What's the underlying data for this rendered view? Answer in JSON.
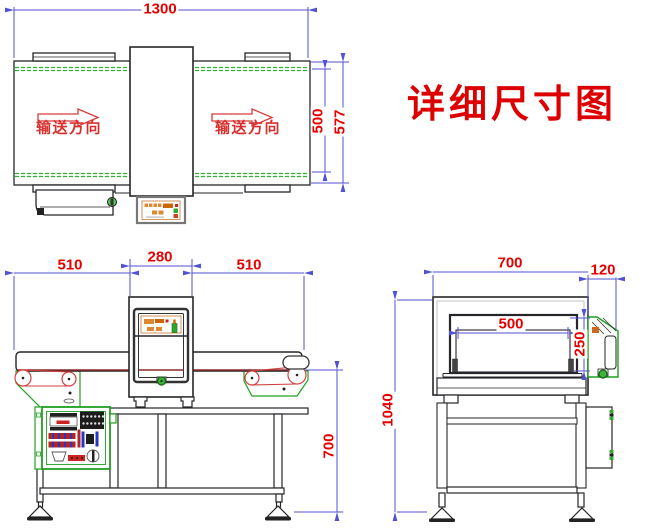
{
  "title": "详细尺寸图",
  "direction_label": "输送方向",
  "dimensions": {
    "top_view": {
      "overall_length": "1300",
      "belt_width": "500",
      "frame_width": "577"
    },
    "front_view": {
      "infeed_length": "510",
      "detector_width": "280",
      "outfeed_length": "510",
      "belt_height": "700"
    },
    "side_view": {
      "machine_width": "700",
      "side_unit_width": "120",
      "tunnel_width": "500",
      "tunnel_height": "250",
      "overall_height": "1040"
    }
  },
  "colors": {
    "dimension_line": "#5151d3",
    "dimension_text": "#e60000",
    "title_text": "#dd0000",
    "belt_edge_green": "#2bb52b",
    "roller_red": "#d24040",
    "panel_orange": "#cc6600",
    "cabinet_green": "#22a022"
  }
}
